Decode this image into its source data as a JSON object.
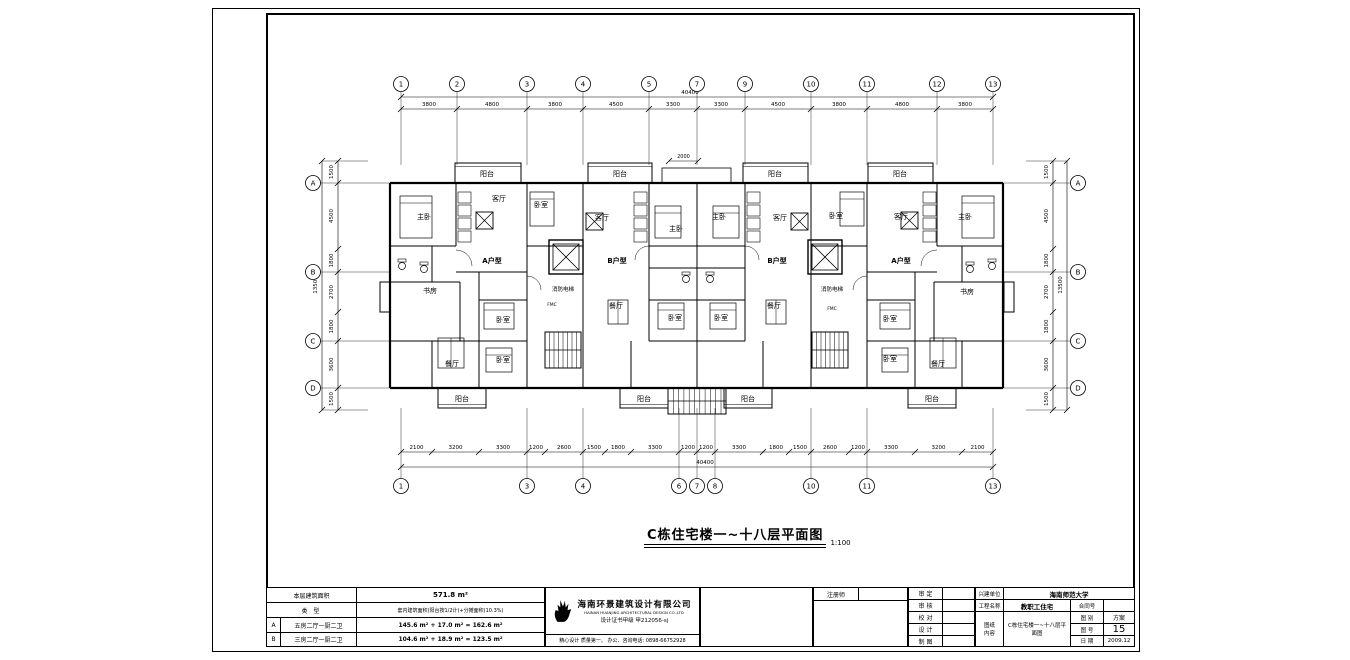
{
  "sheet": {
    "title": "C栋住宅楼一~十八层平面图",
    "scale": "1:100"
  },
  "plan": {
    "rooms": [
      {
        "t": "阳台",
        "x": 487,
        "y": 176
      },
      {
        "t": "阳台",
        "x": 620,
        "y": 176
      },
      {
        "t": "阳台",
        "x": 775,
        "y": 176
      },
      {
        "t": "阳台",
        "x": 900,
        "y": 176
      },
      {
        "t": "阳台",
        "x": 462,
        "y": 401
      },
      {
        "t": "阳台",
        "x": 644,
        "y": 401
      },
      {
        "t": "阳台",
        "x": 748,
        "y": 401
      },
      {
        "t": "阳台",
        "x": 932,
        "y": 401
      },
      {
        "t": "主卧",
        "x": 424,
        "y": 219
      },
      {
        "t": "客厅",
        "x": 499,
        "y": 201
      },
      {
        "t": "A户型",
        "x": 492,
        "y": 263,
        "b": 1
      },
      {
        "t": "书房",
        "x": 430,
        "y": 293
      },
      {
        "t": "卧室",
        "x": 503,
        "y": 322
      },
      {
        "t": "卧室",
        "x": 503,
        "y": 362
      },
      {
        "t": "餐厅",
        "x": 452,
        "y": 366
      },
      {
        "t": "卧室",
        "x": 541,
        "y": 207
      },
      {
        "t": "客厅",
        "x": 602,
        "y": 220
      },
      {
        "t": "B户型",
        "x": 617,
        "y": 263,
        "b": 1
      },
      {
        "t": "主卧",
        "x": 676,
        "y": 231
      },
      {
        "t": "餐厅",
        "x": 616,
        "y": 308
      },
      {
        "t": "卧室",
        "x": 675,
        "y": 320
      },
      {
        "t": "消防电梯",
        "x": 563,
        "y": 291
      },
      {
        "t": "FMC",
        "x": 552,
        "y": 306
      },
      {
        "t": "主卧",
        "x": 719,
        "y": 219
      },
      {
        "t": "客厅",
        "x": 780,
        "y": 220
      },
      {
        "t": "B户型",
        "x": 777,
        "y": 263,
        "b": 1
      },
      {
        "t": "卧室",
        "x": 836,
        "y": 218
      },
      {
        "t": "餐厅",
        "x": 774,
        "y": 308
      },
      {
        "t": "卧室",
        "x": 721,
        "y": 320
      },
      {
        "t": "消防电梯",
        "x": 832,
        "y": 291
      },
      {
        "t": "FMC",
        "x": 832,
        "y": 310
      },
      {
        "t": "客厅",
        "x": 901,
        "y": 219
      },
      {
        "t": "主卧",
        "x": 965,
        "y": 219
      },
      {
        "t": "A户型",
        "x": 901,
        "y": 263,
        "b": 1
      },
      {
        "t": "书房",
        "x": 967,
        "y": 294
      },
      {
        "t": "卧室",
        "x": 890,
        "y": 321
      },
      {
        "t": "卧室",
        "x": 890,
        "y": 361
      },
      {
        "t": "餐厅",
        "x": 938,
        "y": 366
      }
    ],
    "axes": {
      "top": [
        {
          "l": "1",
          "x": 401
        },
        {
          "l": "2",
          "x": 457
        },
        {
          "l": "3",
          "x": 527
        },
        {
          "l": "4",
          "x": 583
        },
        {
          "l": "5",
          "x": 649
        },
        {
          "l": "7",
          "x": 697
        },
        {
          "l": "9",
          "x": 745
        },
        {
          "l": "10",
          "x": 811
        },
        {
          "l": "11",
          "x": 867
        },
        {
          "l": "12",
          "x": 937
        },
        {
          "l": "13",
          "x": 993
        }
      ],
      "bottom": [
        {
          "l": "1",
          "x": 401
        },
        {
          "l": "3",
          "x": 527
        },
        {
          "l": "4",
          "x": 583
        },
        {
          "l": "6",
          "x": 679
        },
        {
          "l": "7",
          "x": 697
        },
        {
          "l": "8",
          "x": 715
        },
        {
          "l": "10",
          "x": 811
        },
        {
          "l": "11",
          "x": 867
        },
        {
          "l": "13",
          "x": 993
        }
      ],
      "side": [
        {
          "l": "A",
          "y": 183
        },
        {
          "l": "B",
          "y": 272
        },
        {
          "l": "C",
          "y": 341
        },
        {
          "l": "D",
          "y": 388
        }
      ]
    },
    "dims": {
      "top_ticks": [
        401,
        457,
        527,
        583,
        649,
        697,
        745,
        811,
        867,
        937,
        993
      ],
      "top_values": [
        "3800",
        "4800",
        "3800",
        "4500",
        "3300",
        "3300",
        "4500",
        "3800",
        "4800",
        "3800"
      ],
      "top_total": "40400",
      "bottom_ticks": [
        401,
        432,
        479,
        527,
        545,
        583,
        605,
        631,
        679,
        697,
        715,
        763,
        789,
        811,
        849,
        867,
        915,
        962,
        993
      ],
      "bottom_values": [
        "2100",
        "3200",
        "3300",
        "1200",
        "2600",
        "1500",
        "1800",
        "3300",
        "1200",
        "1200",
        "3300",
        "1800",
        "1500",
        "2600",
        "1200",
        "3300",
        "3200",
        "2100"
      ],
      "bottom_total": "40400",
      "side_ticks": [
        161,
        183,
        249,
        272,
        312,
        341,
        388,
        410
      ],
      "side_values": [
        "1500",
        "4500",
        "1800",
        "2700",
        "1800",
        "3600",
        "1500"
      ],
      "side_total": "13500",
      "center_top": "2000"
    }
  },
  "area_table": {
    "r1_label": "本层建筑面积",
    "r1_value": "571.8 m²",
    "r2_label": "类  型",
    "r2_value": "套内建筑面积(阳台按1/2计)+分摊面积(10.3%)",
    "r3_key": "A",
    "r3_type": "五房二厅一厨二卫",
    "r3_value": "145.6 m² + 17.0 m² = 162.6 m²",
    "r4_key": "B",
    "r4_type": "三房二厅一厨二卫",
    "r4_value": "104.6 m² + 18.9 m² = 123.5 m²"
  },
  "company": {
    "name_cn": "海南环景建筑设计有限公司",
    "name_en": "HAINAN HUANJING ARCHITECTURAL DESIGN CO.,LTD",
    "cert": "设计证书甲级  甲212056-sj",
    "tagline": "精心设计 质量第一。 办公、咨询电话: 0898-66752928"
  },
  "title_block": {
    "registrar_label": "注册师",
    "approvals": [
      "审 定",
      "审 核",
      "校 对",
      "设 计",
      "制 图"
    ],
    "client_label": "兴建单位",
    "client_value": "海南师范大学",
    "project_label": "工程名称",
    "project_value": "教职工住宅",
    "content_label": "图纸内容",
    "content_value": "C栋住宅楼一~十八层平面图",
    "contract_label": "合同号",
    "type_label": "图 别",
    "type_value": "方案",
    "no_label": "图 号",
    "no_value": "15",
    "date_label": "日 期",
    "date_value": "2009.12"
  }
}
